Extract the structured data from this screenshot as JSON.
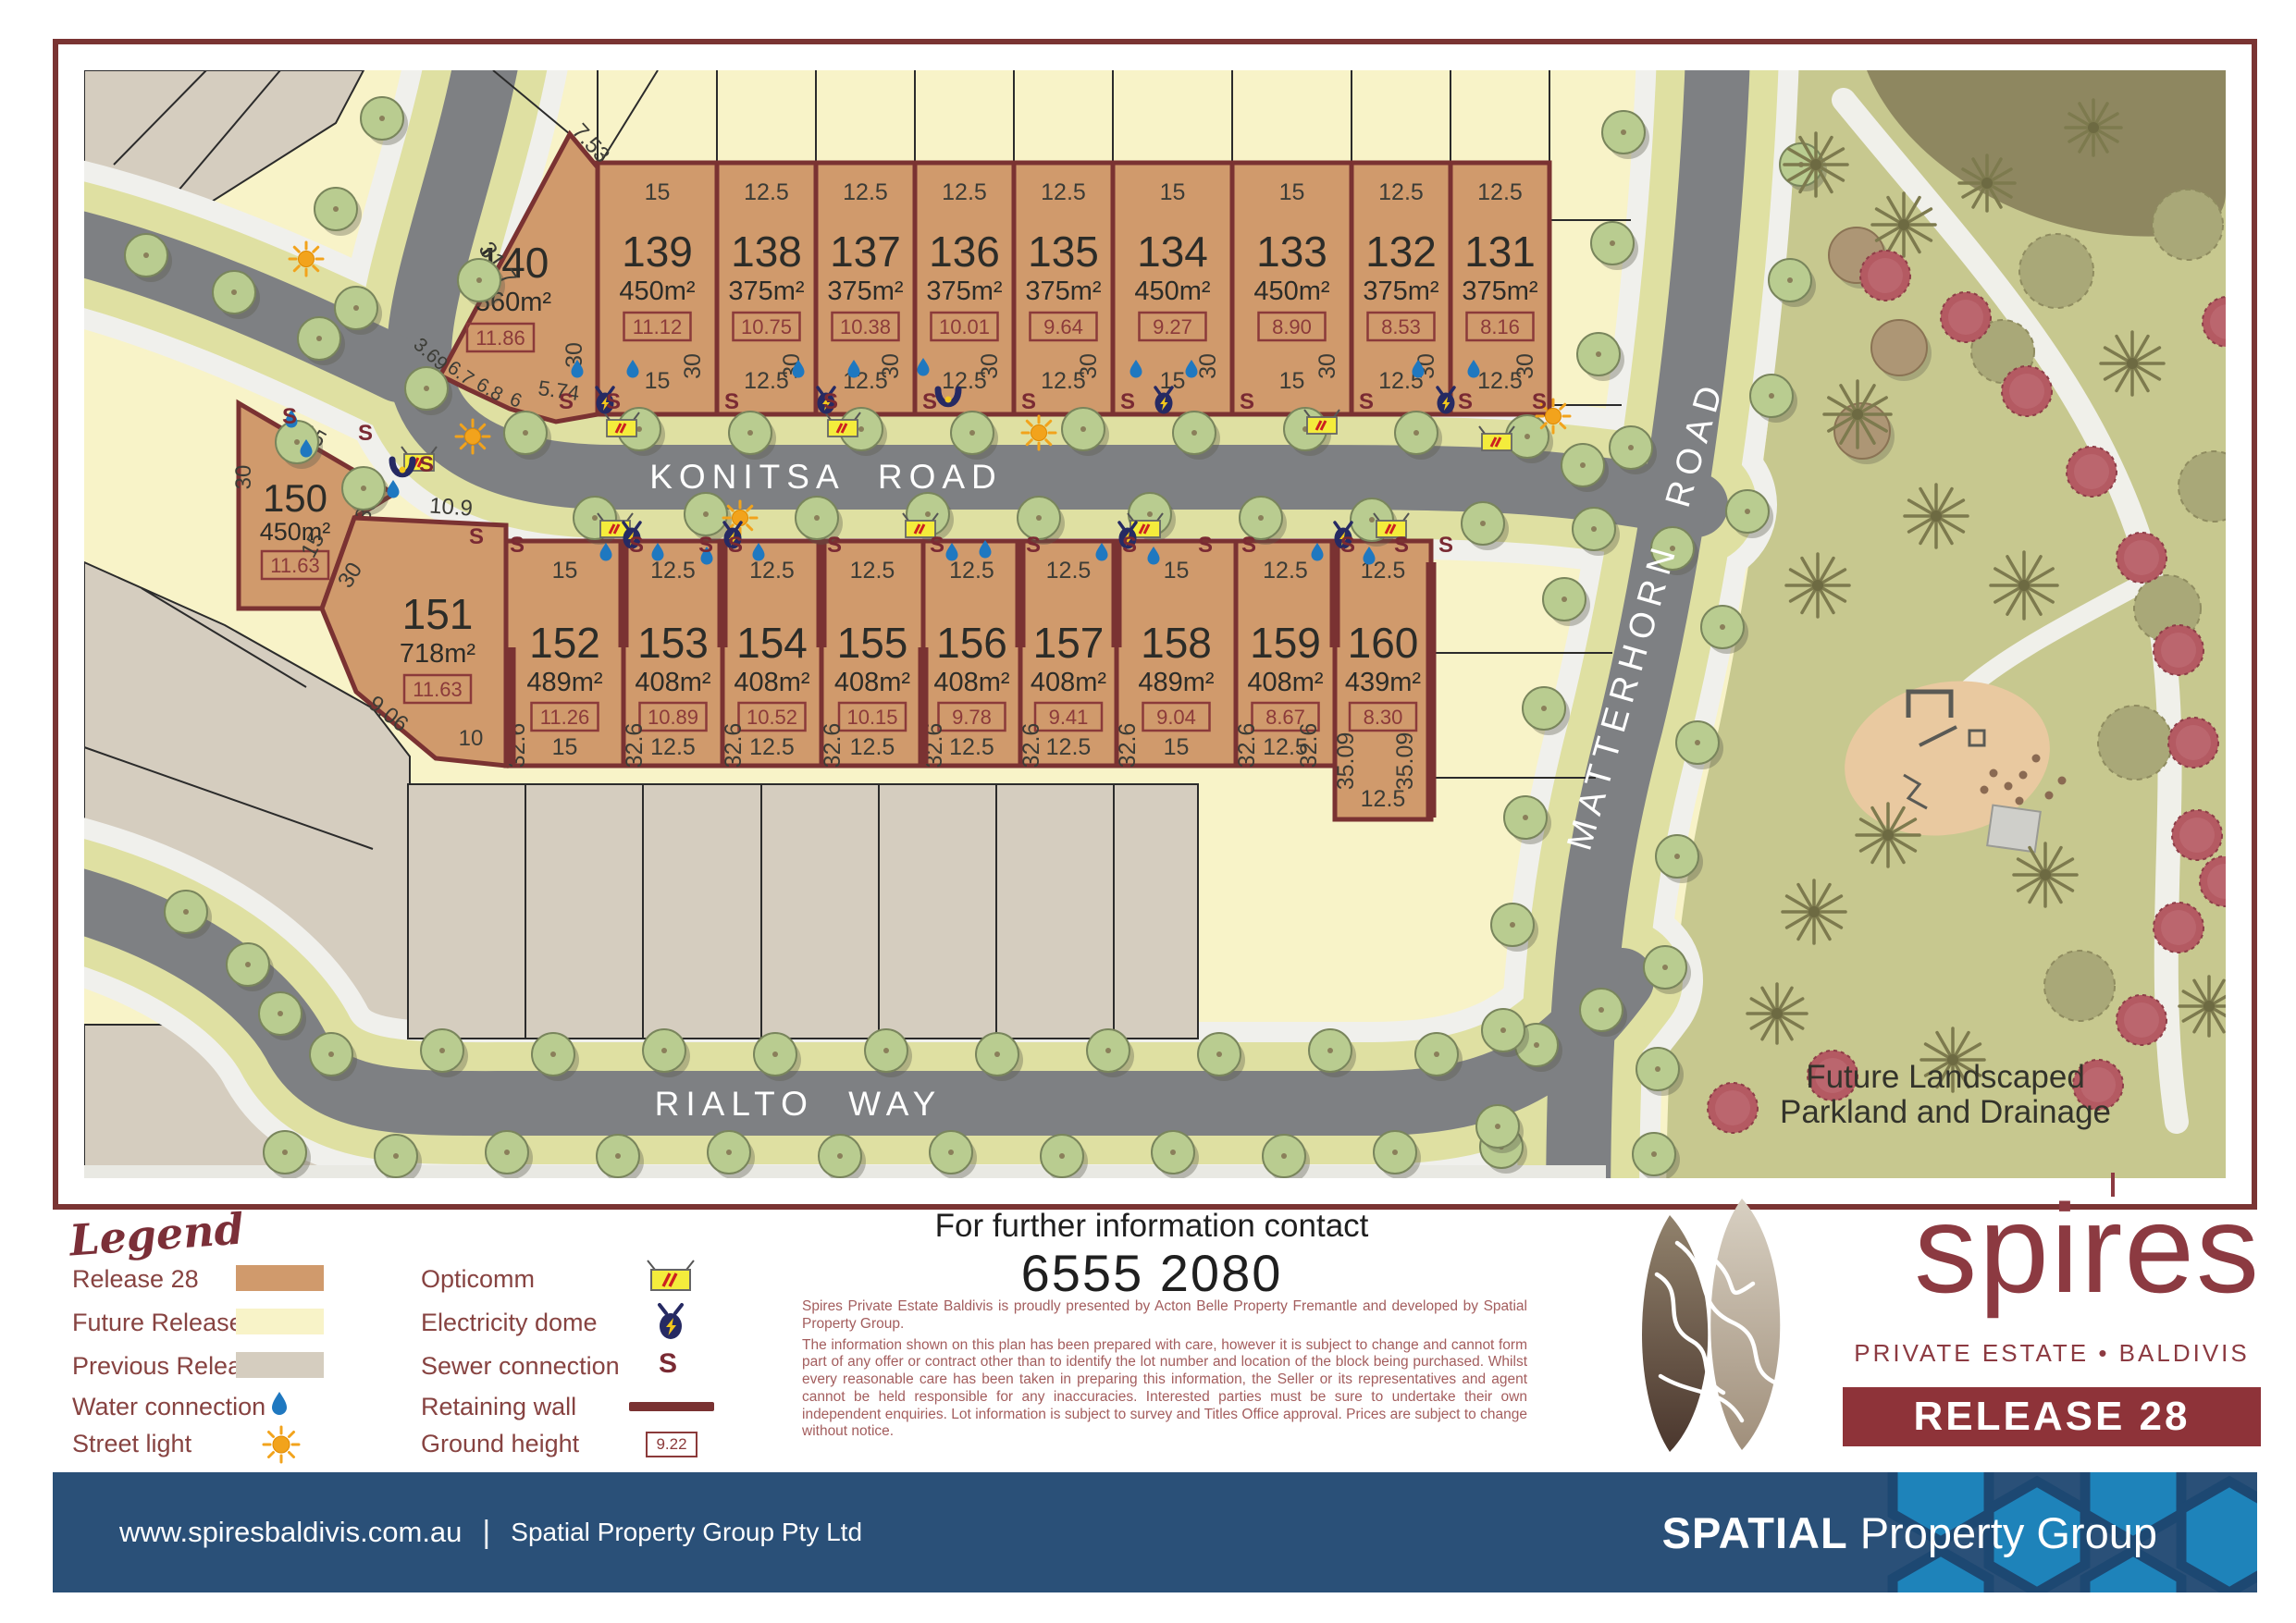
{
  "map": {
    "road_labels": {
      "konitsa": "KONITSA ROAD",
      "rialto": "RIALTO WAY",
      "matterhorn": "MATTERHORN ROAD"
    },
    "parkland": {
      "line1": "Future Landscaped",
      "line2": "Parkland and Drainage"
    },
    "glyphs": {
      "sewer": "S"
    },
    "lots_top": [
      {
        "id": "140",
        "area": "560m²",
        "ground": "11.86",
        "dims": {
          "top_right": "7.53",
          "left": "31.7",
          "b1": "3.69",
          "b2": "6.7",
          "b3": "6.8",
          "b4": "6",
          "b5": "5.74",
          "right": "30"
        }
      },
      {
        "id": "139",
        "area": "450m²",
        "ground": "11.12",
        "top": "15",
        "bottom": "15",
        "side": "30"
      },
      {
        "id": "138",
        "area": "375m²",
        "ground": "10.75",
        "top": "12.5",
        "bottom": "12.5",
        "side": "30"
      },
      {
        "id": "137",
        "area": "375m²",
        "ground": "10.38",
        "top": "12.5",
        "bottom": "12.5",
        "side": "30"
      },
      {
        "id": "136",
        "area": "375m²",
        "ground": "10.01",
        "top": "12.5",
        "bottom": "12.5",
        "side": "30"
      },
      {
        "id": "135",
        "area": "375m²",
        "ground": "9.64",
        "top": "12.5",
        "bottom": "12.5",
        "side": "30"
      },
      {
        "id": "134",
        "area": "450m²",
        "ground": "9.27",
        "top": "15",
        "bottom": "15",
        "side": "30"
      },
      {
        "id": "133",
        "area": "450m²",
        "ground": "8.90",
        "top": "15",
        "bottom": "15",
        "side": "30"
      },
      {
        "id": "132",
        "area": "375m²",
        "ground": "8.53",
        "top": "12.5",
        "bottom": "12.5",
        "side": "30"
      },
      {
        "id": "131",
        "area": "375m²",
        "ground": "8.16",
        "top": "12.5",
        "bottom": "12.5",
        "side": "30"
      }
    ],
    "lots_bottom": [
      {
        "id": "150",
        "area": "450m²",
        "ground": "11.63",
        "dims": {
          "top": "15",
          "left": "30",
          "right": "30"
        }
      },
      {
        "id": "151",
        "area": "718m²",
        "ground": "11.63",
        "dims": {
          "top": "10.9",
          "upper_left": "30",
          "left": "15",
          "lower_left": "9.06",
          "bottom": "10"
        }
      },
      {
        "id": "152",
        "area": "489m²",
        "ground": "11.26",
        "top": "15",
        "bottom": "15",
        "side": "32.6"
      },
      {
        "id": "153",
        "area": "408m²",
        "ground": "10.89",
        "top": "12.5",
        "bottom": "12.5",
        "side": "32.6"
      },
      {
        "id": "154",
        "area": "408m²",
        "ground": "10.52",
        "top": "12.5",
        "bottom": "12.5",
        "side": "32.6"
      },
      {
        "id": "155",
        "area": "408m²",
        "ground": "10.15",
        "top": "12.5",
        "bottom": "12.5",
        "side": "32.6"
      },
      {
        "id": "156",
        "area": "408m²",
        "ground": "9.78",
        "top": "12.5",
        "bottom": "12.5",
        "side": "32.6"
      },
      {
        "id": "157",
        "area": "408m²",
        "ground": "9.41",
        "top": "12.5",
        "bottom": "12.5",
        "side": "32.6"
      },
      {
        "id": "158",
        "area": "489m²",
        "ground": "9.04",
        "top": "15",
        "bottom": "15",
        "side": "32.6"
      },
      {
        "id": "159",
        "area": "408m²",
        "ground": "8.67",
        "top": "12.5",
        "bottom": "12.5",
        "side": "32.6",
        "side2": "32.6"
      },
      {
        "id": "160",
        "area": "439m²",
        "ground": "8.30",
        "top": "12.5",
        "bottom": "12.5",
        "side": "35.09",
        "side2": "35.09"
      }
    ]
  },
  "legend": {
    "title": "Legend",
    "items_left": [
      {
        "label": "Release 28",
        "swatch": "#d09a6c"
      },
      {
        "label": "Future Release",
        "swatch": "#f8f3c8"
      },
      {
        "label": "Previous Release",
        "swatch": "#d5cdbf"
      },
      {
        "label": "Water connection",
        "icon": "water-drop"
      },
      {
        "label": "Street light",
        "icon": "street-light"
      }
    ],
    "items_right": [
      {
        "label": "Opticomm",
        "icon": "opticomm"
      },
      {
        "label": "Electricity dome",
        "icon": "electricity-dome"
      },
      {
        "label": "Sewer connection",
        "icon": "sewer"
      },
      {
        "label": "Retaining wall",
        "icon": "retaining-wall"
      },
      {
        "label": "Ground height",
        "icon": "ground-height",
        "sample": "9.22"
      }
    ]
  },
  "contact": {
    "heading": "For further information contact",
    "phone": "6555 2080",
    "disclaimer1": "Spires Private Estate Baldivis is proudly presented by Acton Belle Property Fremantle and developed by Spatial Property Group.",
    "disclaimer2": "The information shown on this plan has been prepared with care, however it is subject to change and cannot form part of any offer or contract other than to identify the lot number and location of the block being purchased. Whilst every reasonable care has been taken in preparing this information, the Seller or its representatives and agent cannot be held responsible for any inaccuracies. Interested parties must be sure to undertake their own independent enquiries. Lot information is subject to survey and Titles Office approval. Prices are subject to change without notice."
  },
  "brand": {
    "name": "spires",
    "tagline": "PRIVATE ESTATE  •  BALDIVIS",
    "release_banner": "RELEASE 28"
  },
  "footer": {
    "website": "www.spiresbaldivis.com.au",
    "separator": "|",
    "company": "Spatial Property Group Pty Ltd",
    "logo_bold": "SPATIAL",
    "logo_rest": "Property Group"
  }
}
